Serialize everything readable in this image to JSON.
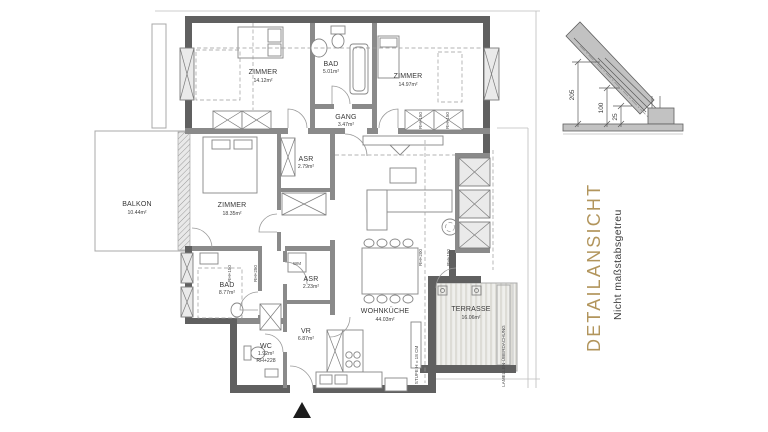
{
  "title_block": {
    "heading": "DETAILANSICHT",
    "subheading": "Nicht maßstabsgetreu",
    "heading_color": "#b2955c"
  },
  "rooms": [
    {
      "name": "ZIMMER",
      "area": "14.12m²"
    },
    {
      "name": "BAD",
      "area": "5.01m²"
    },
    {
      "name": "ZIMMER",
      "area": "14.97m²"
    },
    {
      "name": "GANG",
      "area": "3.47m²"
    },
    {
      "name": "ASR",
      "area": "2.79m²"
    },
    {
      "name": "ZIMMER",
      "area": "18.35m²"
    },
    {
      "name": "BALKON",
      "area": "10.44m²"
    },
    {
      "name": "BAD",
      "area": "8.77m²"
    },
    {
      "name": "ASR",
      "area": "2.23m²"
    },
    {
      "name": "VR",
      "area": "6.87m²"
    },
    {
      "name": "WC",
      "area": "1.92m²",
      "note": "RH+228"
    },
    {
      "name": "WOHNKÜCHE",
      "area": "44.03m²"
    },
    {
      "name": "TERRASSE",
      "area": "16.06m²"
    }
  ],
  "annotations": {
    "wm": "WM",
    "lamellen": "LAMELLEN-ÜBERDACHUNG",
    "stufe": "STUFE H = 18 CM",
    "rh": [
      "RH+150",
      "RH+250",
      "RH+150",
      "RH+150",
      "RH+200",
      "RH+150"
    ]
  },
  "detail_section": {
    "dims": [
      "205",
      "100",
      "25"
    ]
  }
}
